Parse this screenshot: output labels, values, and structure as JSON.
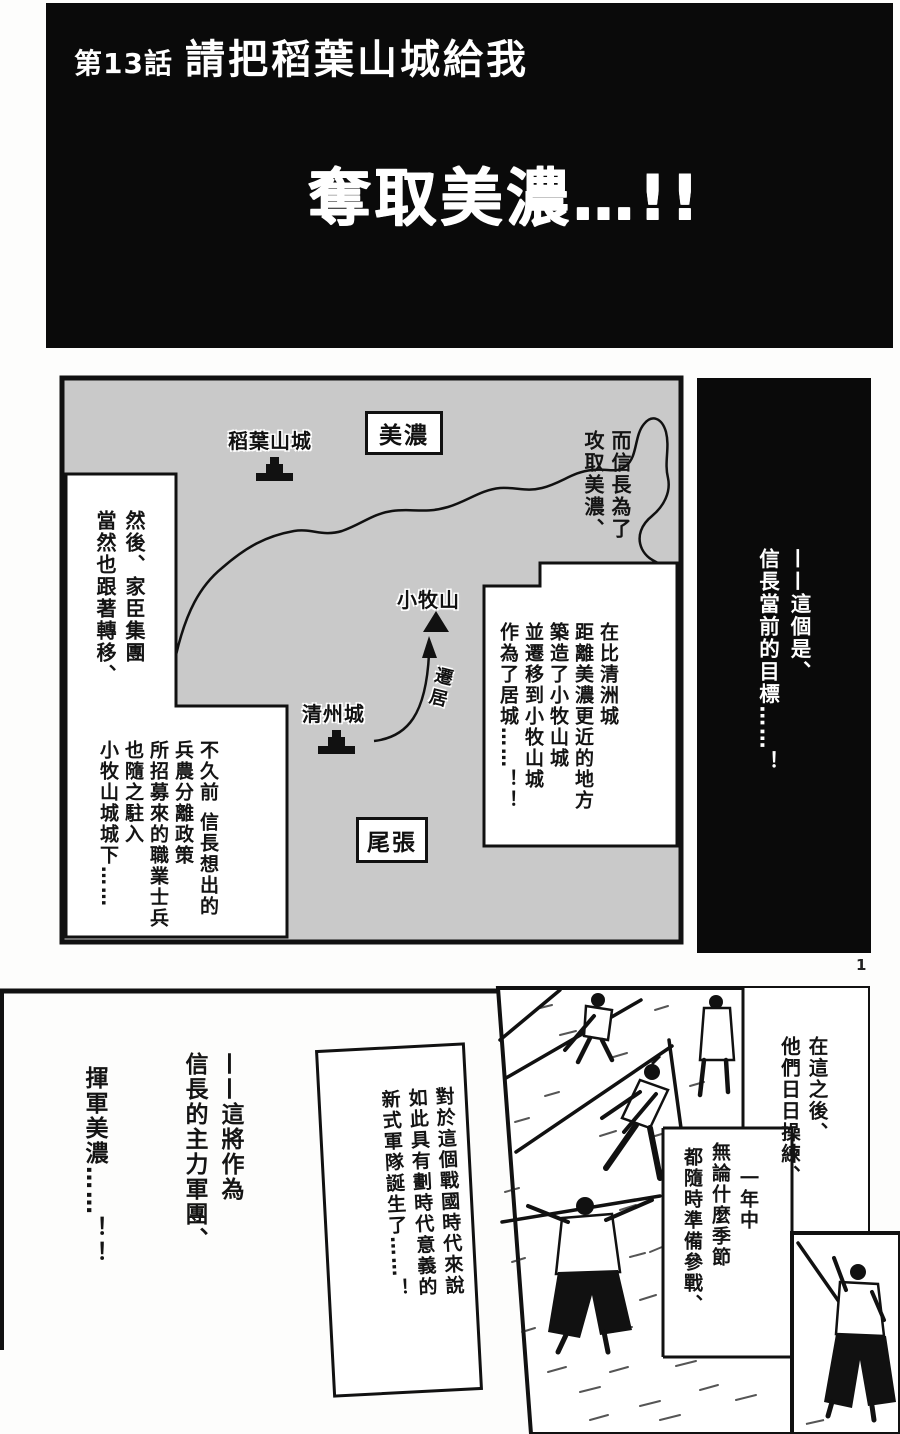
{
  "page_number": "1",
  "header": {
    "chapter_label": "第13話",
    "chapter_title": "請把稻葉山城給我",
    "headline": "奪取美濃…!!"
  },
  "map": {
    "regions": {
      "mino": "美濃",
      "owari": "尾張"
    },
    "places": {
      "inabayama": "稻葉山城",
      "komakiyama": "小牧山",
      "kiyosu": "清州城"
    },
    "arrow_label": "遷居",
    "caption_move": {
      "cols": [
        "而信長為了",
        "攻取美濃、"
      ]
    },
    "caption_retainers": {
      "cols": [
        "然後、家臣集團",
        "當然也跟著轉移、"
      ]
    },
    "caption_build": {
      "cols": [
        "在比清洲城",
        "距離美濃更近的地方",
        "築造了小牧山城",
        "並遷移到小牧山城",
        "作為了居城……！！"
      ]
    },
    "caption_soldiers": {
      "cols": [
        "不久前 信長想出的",
        "兵農分離政策",
        "所招募來的職業士兵",
        "也隨之駐入",
        "小牧山城城下……"
      ]
    }
  },
  "sidebar": {
    "cols": [
      "——這個是、",
      "信長當前的目標……！"
    ]
  },
  "bottom": {
    "caption_training": {
      "cols": [
        "在這之後、",
        "他們日日操練、"
      ]
    },
    "caption_seasons": {
      "cols": [
        "一年中",
        "無論什麼季節",
        "都隨時準備參戰、"
      ]
    },
    "caption_army": {
      "cols": [
        "對於這個戰國時代來說",
        "如此具有劃時代意義的",
        "新式軍隊誕生了……！"
      ]
    },
    "narration_main": {
      "cols": [
        "——這將作為",
        "信長的主力軍團、"
      ]
    },
    "narration_march": {
      "cols": [
        "揮軍美濃……！！"
      ]
    }
  }
}
